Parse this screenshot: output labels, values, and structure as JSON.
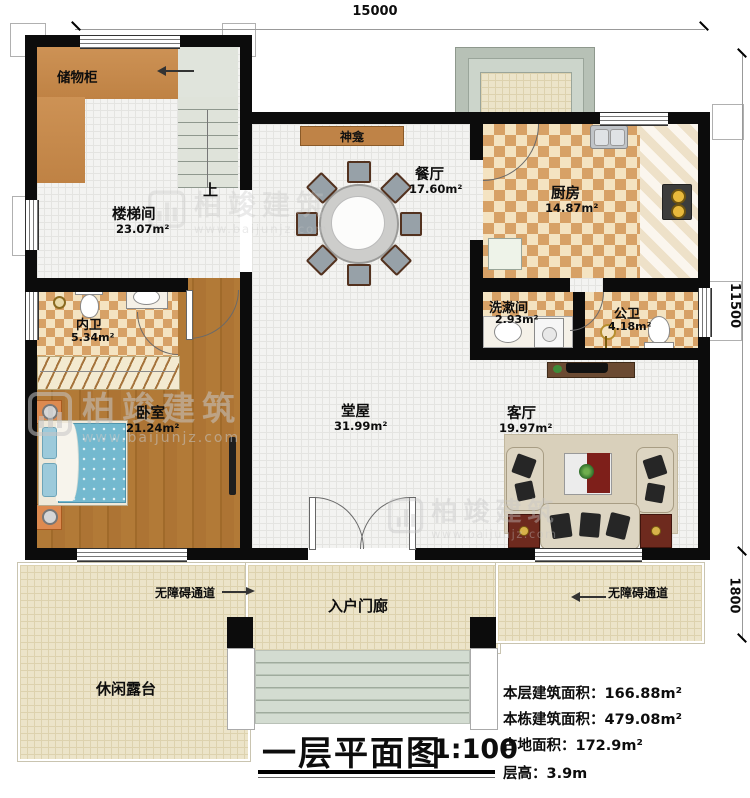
{
  "title": {
    "text": "一层平面图",
    "scale": "1:100"
  },
  "dimensions": {
    "top": "15000",
    "right": "11500",
    "right_lower": "1800"
  },
  "rooms": {
    "storage": {
      "name": "储物柜"
    },
    "stairwell": {
      "name": "楼梯间",
      "area": "23.07m²"
    },
    "shrine": {
      "name": "神龛"
    },
    "dining": {
      "name": "餐厅",
      "area": "17.60m²"
    },
    "kitchen": {
      "name": "厨房",
      "area": "14.87m²"
    },
    "washroom": {
      "name": "洗漱间",
      "area": "2.93m²"
    },
    "public_bath": {
      "name": "公卫",
      "area": "4.18m²"
    },
    "private_bath": {
      "name": "内卫",
      "area": "5.34m²"
    },
    "bedroom": {
      "name": "卧室",
      "area": "21.24m²"
    },
    "hall": {
      "name": "堂屋",
      "area": "31.99m²"
    },
    "living": {
      "name": "客厅",
      "area": "19.97m²"
    },
    "porch": {
      "name": "入户门廊"
    },
    "terrace": {
      "name": "休闲露台"
    }
  },
  "annotations": {
    "stairs_up": "上",
    "ramp_left": "无障碍通道",
    "ramp_right": "无障碍通道"
  },
  "stats": {
    "line1": {
      "label": "本层建筑面积：",
      "value": "166.88m²"
    },
    "line2": {
      "label": "本栋建筑面积：",
      "value": "479.08m²"
    },
    "line3": {
      "label": "占地面积：",
      "value": "172.9m²"
    },
    "line4": {
      "label": "层高：",
      "value": "3.9m"
    }
  },
  "watermark": {
    "brand": "柏竣建筑",
    "site": "www.baijunjz.com"
  },
  "colors": {
    "wall": "#0c0c0c",
    "wood": "#ad7434",
    "tile_accent": "#d7a166",
    "outdoor_floor": "#ece4c9",
    "bed_blue": "#74b9cf",
    "accent_red": "#6e2a1e",
    "steps_green": "#d3dcd1"
  }
}
